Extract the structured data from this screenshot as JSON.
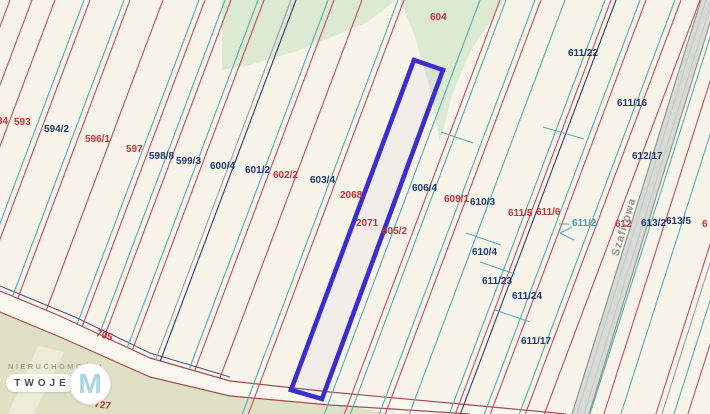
{
  "map": {
    "background_color": "#f8f4ea",
    "line_colors": {
      "P": "#c24f66",
      "C": "#55aeb5",
      "N": "#2c4079",
      "G": "#99a0ab"
    },
    "label_colors": {
      "red": "#c5323a",
      "navy": "#1d3a6d",
      "teal": "#3f9fae"
    },
    "line_slope": 0.376,
    "parcel_labels": [
      {
        "t": "34",
        "x": -3,
        "y": 116,
        "c": "red"
      },
      {
        "t": "593",
        "x": 14,
        "y": 117,
        "c": "red"
      },
      {
        "t": "594/2",
        "x": 44,
        "y": 124,
        "c": "navy"
      },
      {
        "t": "596/1",
        "x": 85,
        "y": 134,
        "c": "red"
      },
      {
        "t": "597",
        "x": 126,
        "y": 144,
        "c": "red"
      },
      {
        "t": "598/8",
        "x": 149,
        "y": 151,
        "c": "navy"
      },
      {
        "t": "599/3",
        "x": 176,
        "y": 156,
        "c": "navy"
      },
      {
        "t": "600/4",
        "x": 210,
        "y": 161,
        "c": "navy"
      },
      {
        "t": "601/2",
        "x": 245,
        "y": 165,
        "c": "navy"
      },
      {
        "t": "602/2",
        "x": 273,
        "y": 170,
        "c": "red"
      },
      {
        "t": "603/4",
        "x": 310,
        "y": 175,
        "c": "navy"
      },
      {
        "t": "604",
        "x": 430,
        "y": 12,
        "c": "red"
      },
      {
        "t": "2068",
        "x": 340,
        "y": 190,
        "c": "red"
      },
      {
        "t": "2071",
        "x": 356,
        "y": 218,
        "c": "red"
      },
      {
        "t": "605/2",
        "x": 382,
        "y": 226,
        "c": "red"
      },
      {
        "t": "606/4",
        "x": 412,
        "y": 183,
        "c": "navy"
      },
      {
        "t": "609/1",
        "x": 444,
        "y": 194,
        "c": "red"
      },
      {
        "t": "610/3",
        "x": 470,
        "y": 197,
        "c": "navy"
      },
      {
        "t": "611/5",
        "x": 508,
        "y": 208,
        "c": "red"
      },
      {
        "t": "611/6",
        "x": 536,
        "y": 207,
        "c": "red"
      },
      {
        "t": "611/2",
        "x": 572,
        "y": 218,
        "c": "teal"
      },
      {
        "t": "610/4",
        "x": 472,
        "y": 247,
        "c": "navy"
      },
      {
        "t": "611/23",
        "x": 482,
        "y": 276,
        "c": "navy"
      },
      {
        "t": "611/24",
        "x": 512,
        "y": 291,
        "c": "navy"
      },
      {
        "t": "611/17",
        "x": 521,
        "y": 336,
        "c": "navy"
      },
      {
        "t": "611/22",
        "x": 568,
        "y": 48,
        "c": "navy"
      },
      {
        "t": "611/16",
        "x": 617,
        "y": 98,
        "c": "navy"
      },
      {
        "t": "612/17",
        "x": 632,
        "y": 151,
        "c": "navy"
      },
      {
        "t": "612",
        "x": 615,
        "y": 219,
        "c": "red"
      },
      {
        "t": "613/2",
        "x": 641,
        "y": 218,
        "c": "navy"
      },
      {
        "t": "613/5",
        "x": 666,
        "y": 216,
        "c": "navy"
      },
      {
        "t": "6",
        "x": 702,
        "y": 219,
        "c": "red"
      },
      {
        "t": "705",
        "x": 98,
        "y": 328,
        "c": "red",
        "r": 18
      },
      {
        "t": "725/1",
        "x": 12,
        "y": 382,
        "c": "red",
        "r": 4
      },
      {
        "t": "727",
        "x": 95,
        "y": 399,
        "c": "red",
        "r": 8
      }
    ],
    "street_name": {
      "text": "Szafirowa",
      "x": 629,
      "y": 229,
      "rotation": -73
    },
    "highlight_parcel": {
      "points": [
        [
          414,
          60
        ],
        [
          443,
          70
        ],
        [
          322,
          399
        ],
        [
          291,
          390
        ]
      ],
      "stroke": "#3b2ed0",
      "stroke_width": 4.6
    },
    "boundary_lines": [
      {
        "x0": 10,
        "c": "P",
        "clip": true
      },
      {
        "x0": 32,
        "c": "P",
        "clip": true
      },
      {
        "x0": 55,
        "c": "P",
        "clip": true
      },
      {
        "x0": 84,
        "c": "C",
        "clip": true
      },
      {
        "x0": 90,
        "c": "P",
        "clip": true
      },
      {
        "x0": 124,
        "c": "C",
        "clip": true
      },
      {
        "x0": 130,
        "c": "P",
        "clip": true
      },
      {
        "x0": 163,
        "c": "P",
        "clip": true
      },
      {
        "x0": 199,
        "c": "C",
        "clip": true
      },
      {
        "x0": 205,
        "c": "P",
        "clip": true
      },
      {
        "x0": 225,
        "c": "C",
        "clip": true
      },
      {
        "x0": 231,
        "c": "P",
        "clip": true
      },
      {
        "x0": 258,
        "c": "C",
        "clip": true
      },
      {
        "x0": 264,
        "c": "P",
        "clip": true
      },
      {
        "x0": 291,
        "c": "G",
        "clip": true
      },
      {
        "x0": 296,
        "c": "N",
        "clip": true
      },
      {
        "x0": 328,
        "c": "C",
        "clip": true
      },
      {
        "x0": 334,
        "c": "P",
        "clip": true
      },
      {
        "x0": 362,
        "c": "P",
        "clip": true
      },
      {
        "x0": 398,
        "c": "C"
      },
      {
        "x0": 404,
        "c": "P"
      },
      {
        "x0": 480,
        "c": "C"
      },
      {
        "x0": 500,
        "c": "P"
      },
      {
        "x0": 506,
        "c": "C"
      },
      {
        "x0": 535,
        "c": "C"
      },
      {
        "x0": 541,
        "c": "P"
      },
      {
        "x0": 565,
        "c": "C"
      },
      {
        "x0": 605,
        "c": "C"
      },
      {
        "x0": 611,
        "c": "P"
      },
      {
        "x0": 616,
        "c": "N"
      },
      {
        "x0": 640,
        "c": "C"
      },
      {
        "x0": 646,
        "c": "P"
      },
      {
        "x0": 675,
        "c": "C"
      },
      {
        "x0": 681,
        "c": "P"
      },
      {
        "x0": 700,
        "c": "P"
      },
      {
        "x0": 722,
        "c": "C",
        "s": 0.319
      },
      {
        "x0": 736,
        "c": "P",
        "s": 0.319
      },
      {
        "x0": 753,
        "c": "C",
        "s": 0.319
      },
      {
        "x0": 788,
        "c": "P",
        "s": 0.319
      },
      {
        "x0": 794,
        "c": "G",
        "s": 0.319
      },
      {
        "x0": 806,
        "c": "C",
        "s": 0.319
      },
      {
        "x0": 820,
        "c": "P",
        "s": 0.319
      }
    ],
    "cross_segments": [
      {
        "pts": [
          [
            543,
            127
          ],
          [
            584,
            139
          ]
        ],
        "c": "C"
      },
      {
        "pts": [
          [
            441,
            132
          ],
          [
            473,
            143
          ]
        ],
        "c": "C"
      },
      {
        "pts": [
          [
            466,
            233
          ],
          [
            501,
            245
          ]
        ],
        "c": "C"
      },
      {
        "pts": [
          [
            480,
            262
          ],
          [
            515,
            274
          ]
        ],
        "c": "C"
      },
      {
        "pts": [
          [
            495,
            310
          ],
          [
            530,
            322
          ]
        ],
        "c": "C"
      },
      {
        "pts": [
          [
            559,
            224
          ],
          [
            569,
            224
          ]
        ],
        "c": "C"
      },
      {
        "pts": [
          [
            572,
            227
          ],
          [
            560,
            233
          ]
        ],
        "c": "C"
      },
      {
        "pts": [
          [
            560,
            233
          ],
          [
            574,
            240
          ]
        ],
        "c": "C"
      }
    ],
    "green_areas": {
      "fill": "#dcead2",
      "polygons": [
        [
          [
            222,
            0
          ],
          [
            396,
            0
          ],
          [
            368,
            22
          ],
          [
            300,
            50
          ],
          [
            246,
            66
          ],
          [
            222,
            70
          ]
        ],
        [
          [
            400,
            0
          ],
          [
            504,
            0
          ],
          [
            470,
            52
          ],
          [
            452,
            95
          ],
          [
            440,
            143
          ],
          [
            430,
            88
          ],
          [
            414,
            34
          ]
        ]
      ]
    },
    "khaki_area": {
      "fill": "#dfe1c4",
      "polygon": [
        [
          0,
          309
        ],
        [
          40,
          325
        ],
        [
          150,
          371
        ],
        [
          240,
          392
        ],
        [
          330,
          402
        ],
        [
          392,
          414
        ],
        [
          0,
          414
        ]
      ]
    },
    "khaki_light_strip": {
      "fill": "#edecd9",
      "polygon": [
        [
          38,
          346
        ],
        [
          64,
          352
        ],
        [
          34,
          414
        ],
        [
          8,
          414
        ]
      ]
    },
    "road_705": {
      "fill": "#faf7ee",
      "edge_color": "#a84a52",
      "dark_edge_color": "#3f4f86",
      "upper": [
        [
          0,
          291
        ],
        [
          60,
          316
        ],
        [
          150,
          358
        ],
        [
          230,
          381
        ],
        [
          330,
          392
        ],
        [
          460,
          404
        ],
        [
          566,
          414
        ]
      ],
      "lower": [
        [
          0,
          312
        ],
        [
          60,
          337
        ],
        [
          150,
          377
        ],
        [
          230,
          396
        ],
        [
          330,
          405
        ],
        [
          470,
          414
        ]
      ],
      "dark_upper": [
        [
          0,
          286
        ],
        [
          75,
          317
        ],
        [
          150,
          353
        ],
        [
          230,
          377
        ]
      ]
    },
    "road_szafirowa": {
      "fill": "#d8dbd5",
      "edge_color": "#8f9792",
      "inner_color": "#c2c7c2",
      "polygon": [
        [
          701,
          0
        ],
        [
          717,
          0
        ],
        [
          589,
          414
        ],
        [
          572,
          414
        ]
      ],
      "edges": [
        [
          [
            701,
            0
          ],
          [
            572,
            414
          ]
        ],
        [
          [
            717,
            0
          ],
          [
            589,
            414
          ]
        ]
      ],
      "inner_lines": [
        [
          [
            706,
            0
          ],
          [
            577,
            414
          ]
        ],
        [
          [
            712,
            0
          ],
          [
            584,
            414
          ]
        ]
      ]
    }
  },
  "watermark": {
    "line1": "NIERUCHOMOŚCI",
    "line2": "TWOJE",
    "monogram": "M",
    "monogram_color": "#a9d6e5"
  }
}
